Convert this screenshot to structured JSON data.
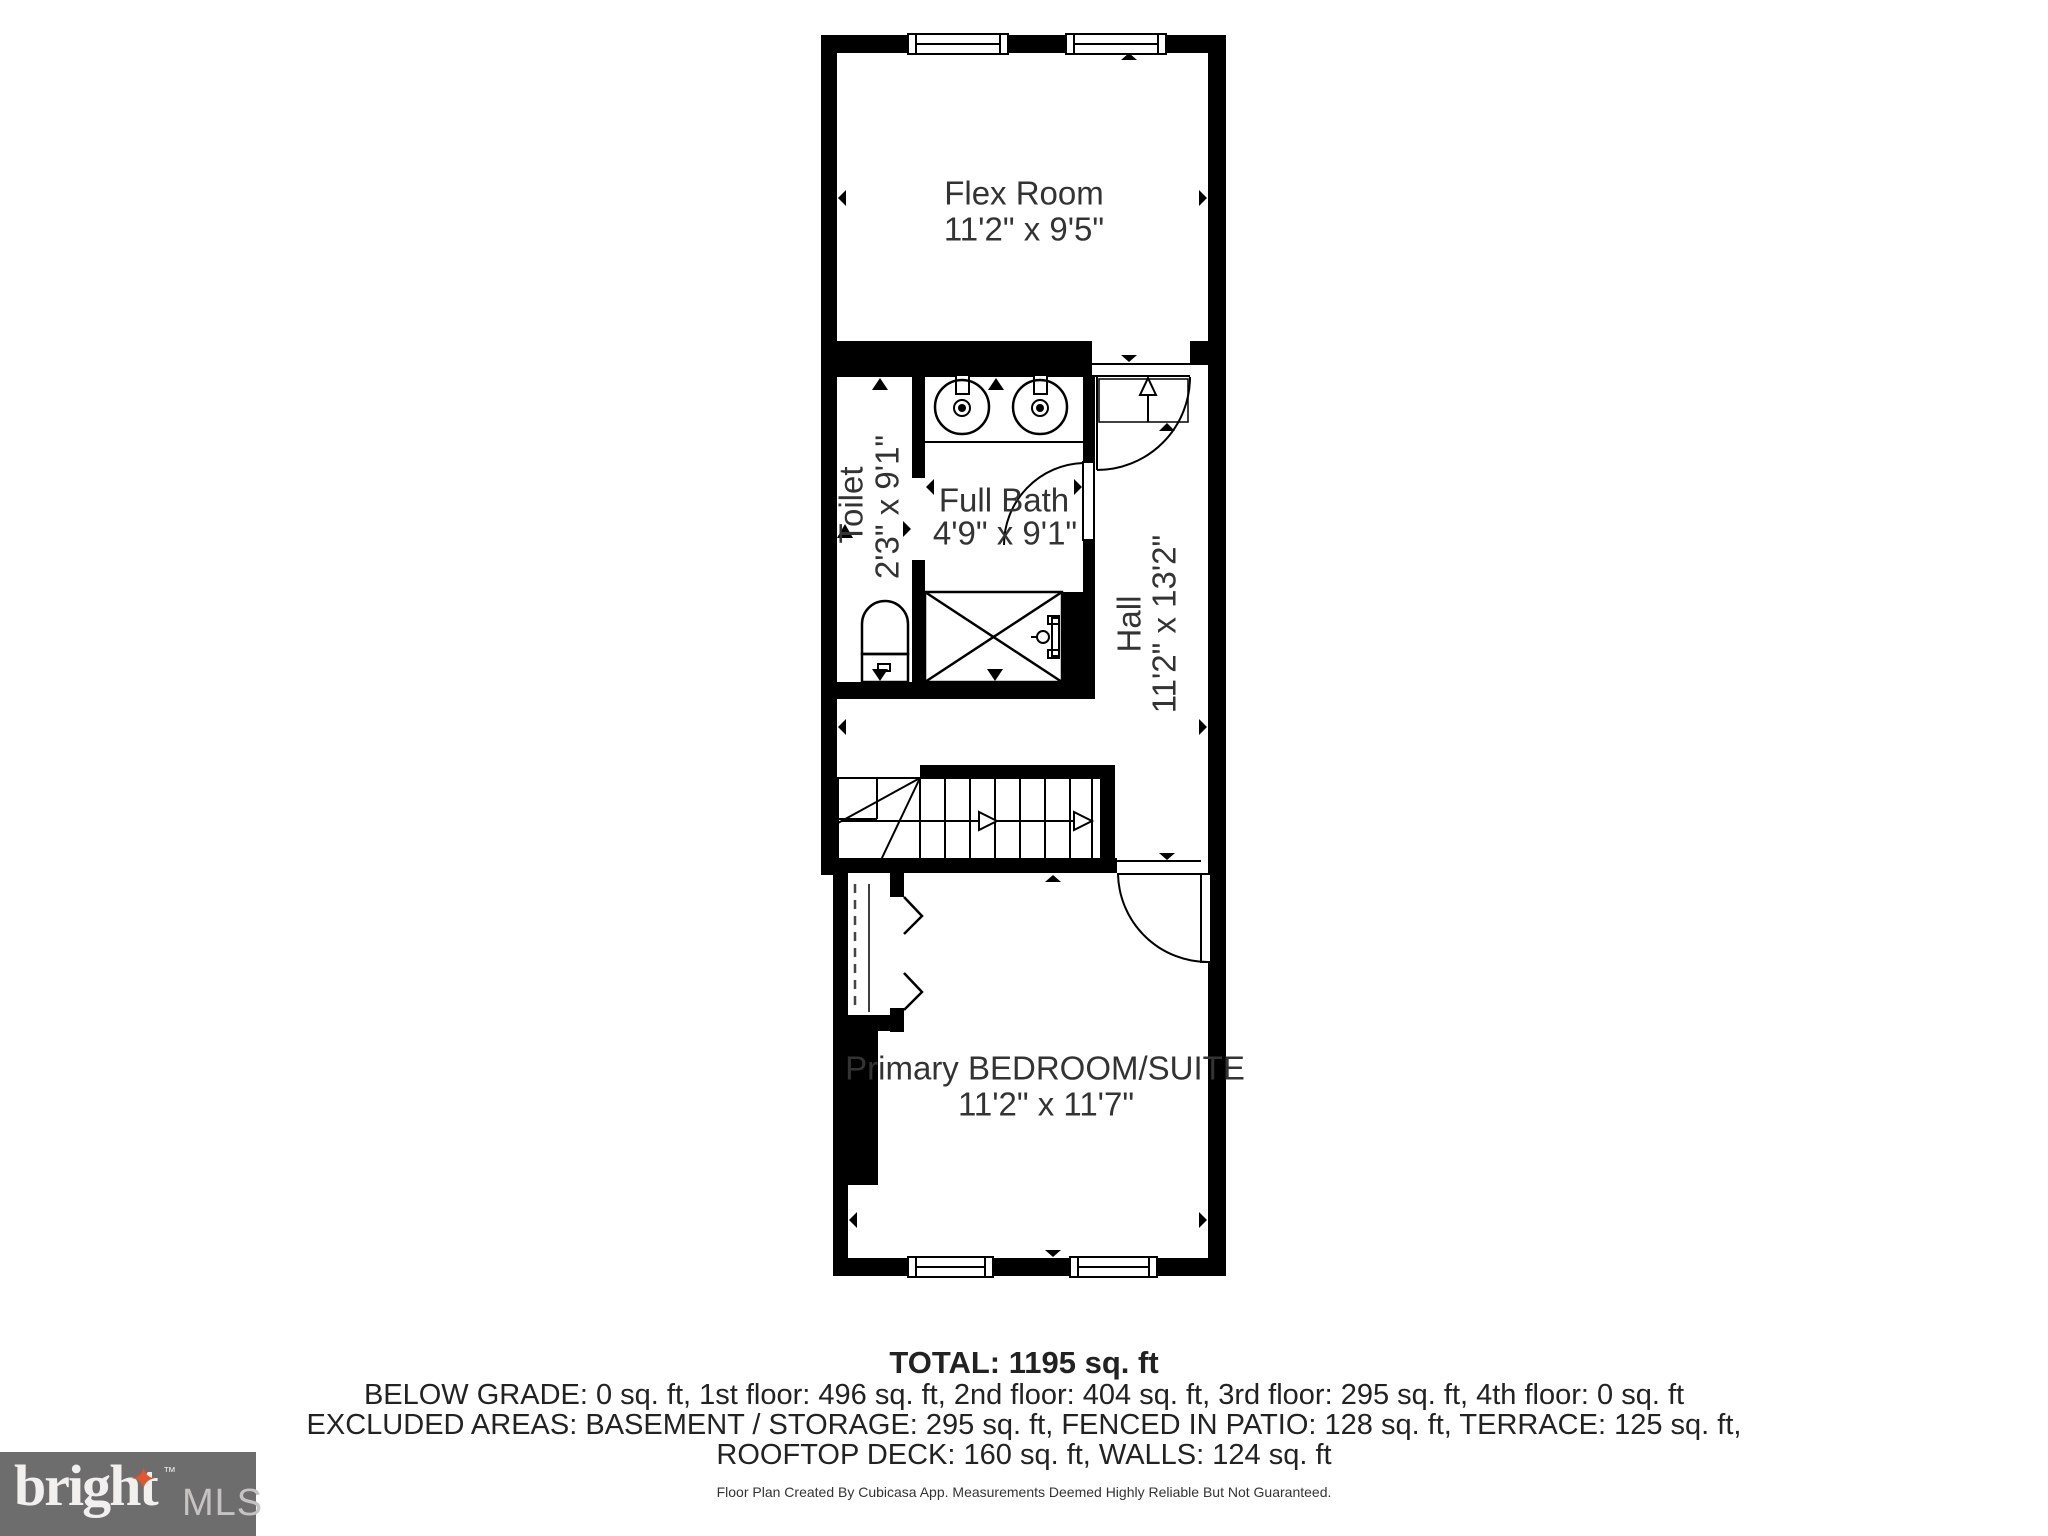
{
  "plan": {
    "rooms": [
      {
        "id": "flex",
        "name": "Flex Room",
        "dims": "11'2\" x 9'5\""
      },
      {
        "id": "toilet",
        "name": "Toilet",
        "dims": "2'3\" x 9'1\""
      },
      {
        "id": "bath",
        "name": "Full Bath",
        "dims": "4'9\" x 9'1\""
      },
      {
        "id": "hall",
        "name": "Hall",
        "dims": "11'2\" x 13'2\""
      },
      {
        "id": "bedroom",
        "name": "Primary BEDROOM/SUITE",
        "dims": "11'2\" x 11'7\""
      }
    ]
  },
  "summary": {
    "total": "TOTAL: 1195 sq. ft",
    "line1": "BELOW GRADE: 0 sq. ft, 1st floor: 496 sq. ft, 2nd floor: 404 sq. ft, 3rd floor: 295 sq. ft, 4th floor: 0 sq. ft",
    "line2": "EXCLUDED AREAS: BASEMENT / STORAGE: 295 sq. ft, FENCED IN PATIO: 128 sq. ft, TERRACE: 125 sq. ft,",
    "line3": "ROOFTOP DECK: 160 sq. ft, WALLS: 124 sq. ft"
  },
  "footer": {
    "disclaimer": "Floor Plan Created By Cubicasa App. Measurements Deemed Highly Reliable But Not Guaranteed."
  },
  "logo": {
    "brand": "bright",
    "trademark": "TM",
    "mls": "MLS",
    "star_glyph": "✦",
    "colors": {
      "background": "#6d6d6d",
      "star": "#e0572f",
      "brand_text": "#f2f0ee",
      "mls_text": "#c6c4c2"
    }
  }
}
